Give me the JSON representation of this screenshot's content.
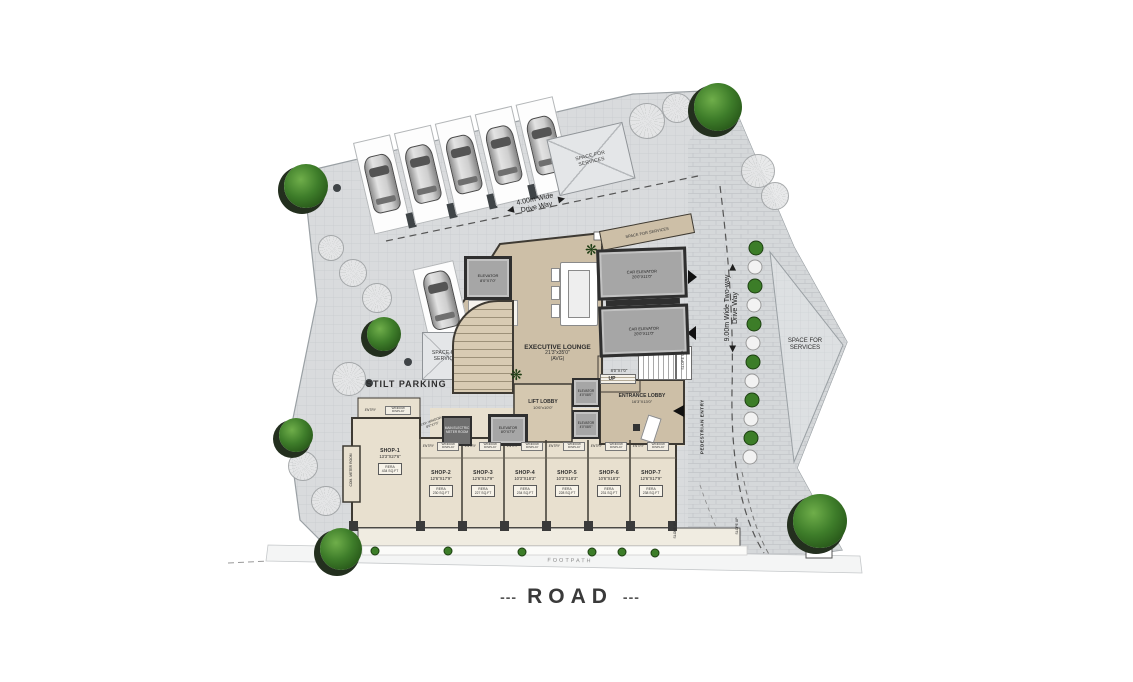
{
  "site": {
    "road": "ROAD",
    "road_dash_left": "---",
    "road_dash_right": "---",
    "footpath": "FOOTPATH",
    "stilt_parking": "STILT PARKING",
    "space_for_services": "SPACE FOR SERVICES",
    "security_cabin": "Security Cabin"
  },
  "driveways": {
    "top_line1": "4.00m Wide",
    "top_line2": "Drive Way",
    "right_line1": "9.00m Wide Two-way",
    "right_line2": "Drive Way",
    "pedestrian_entry": "PEDESTRIAN ENTRY",
    "slope_up": "SLOPE UP",
    "up": "UP"
  },
  "core": {
    "executive_lounge": {
      "name": "EXECUTIVE LOUNGE",
      "dims": "21'3\"x35'0\"",
      "note": "(AVG)"
    },
    "lift_lobby": {
      "name": "LIFT LOBBY",
      "dims": "10'6\"x10'0\""
    },
    "entrance_lobby": {
      "name": "ENTRANCE LOBBY",
      "dims": "16'3\"X13'0\""
    },
    "car_elevator": {
      "name": "CAR ELEVATOR",
      "dims": "20'0\"X11'0\""
    },
    "elevator_top": {
      "name": "ELEVATOR",
      "dims": "8'0\"X7'0\""
    },
    "elevator_small": {
      "name": "ELEVATOR",
      "dims": "4'0\"X8'0\""
    },
    "elevator_lobby": {
      "name": "ELEVATOR",
      "dims": "8'0\"X7'0\""
    },
    "meter_room": "MAIN ELECTRIC METER ROOM",
    "com_meter_room": "COM. METER ROOM",
    "exp_window": "EXP. WINDOW 8'0\"X7'0\"",
    "terrace_room": "TOW ROOM TERRACE",
    "small_room_dims": "8'0\"X7'0\"",
    "entry": "ENTRY",
    "window_display": "WINDOW DISPLAY"
  },
  "shops": [
    {
      "name": "SHOP-1",
      "dims": "13'3\"X27'6\"",
      "rera_label": "RERA",
      "rera_value": "434 SQ.FT"
    },
    {
      "name": "SHOP-2",
      "dims": "12'6\"X17'9\"",
      "rera_label": "RERA",
      "rera_value": "230 SQ.FT"
    },
    {
      "name": "SHOP-3",
      "dims": "12'6\"X17'9\"",
      "rera_label": "RERA",
      "rera_value": "227 SQ.FT"
    },
    {
      "name": "SHOP-4",
      "dims": "10'3\"X18'3\"",
      "rera_label": "RERA",
      "rera_value": "234 SQ.FT"
    },
    {
      "name": "SHOP-5",
      "dims": "10'3\"X18'3\"",
      "rera_label": "RERA",
      "rera_value": "228 SQ.FT"
    },
    {
      "name": "SHOP-6",
      "dims": "10'6\"X18'3\"",
      "rera_label": "RERA",
      "rera_value": "231 SQ.FT"
    },
    {
      "name": "SHOP-7",
      "dims": "12'6\"X17'9\"",
      "rera_label": "RERA",
      "rera_value": "238 SQ.FT"
    }
  ],
  "colors": {
    "paver_gray": "#d9dbdd",
    "building_beige": "#cdbfa7",
    "shop_beige": "#e8e0cf",
    "wall_dark": "#3e3a33",
    "tree_green": "#3e7d2a"
  }
}
